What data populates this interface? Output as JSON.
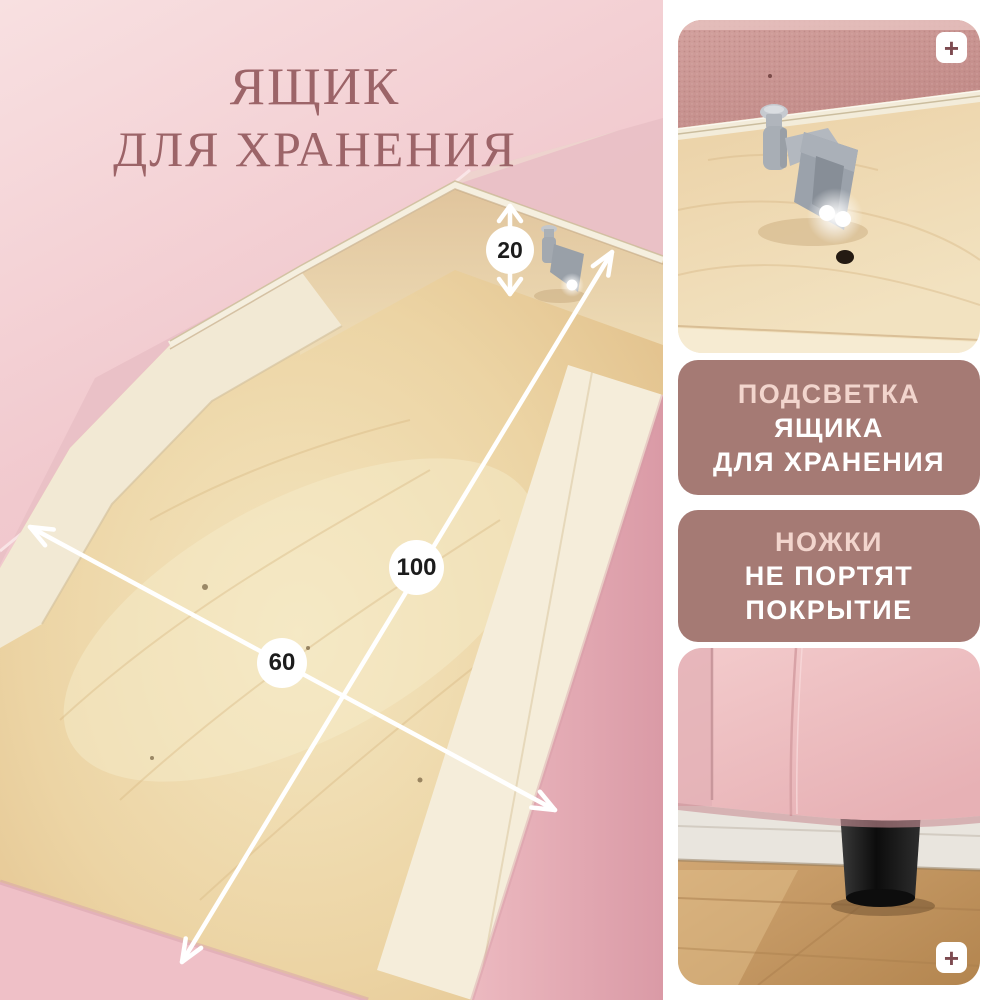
{
  "main_photo": {
    "title_line1": "ЯЩИК",
    "title_line2": "ДЛЯ ХРАНЕНИЯ",
    "dim_height": "20",
    "dim_length": "100",
    "dim_width": "60"
  },
  "side": {
    "panel_light": {
      "accent": "ПОДСВЕТКА",
      "line2": "ЯЩИКА",
      "line3": "ДЛЯ ХРАНЕНИЯ"
    },
    "panel_legs": {
      "accent": "НОЖКИ",
      "line2": "НЕ ПОРТЯТ",
      "line3": "ПОКРЫТИЕ"
    },
    "zoom_button_top": "+",
    "zoom_button_bottom": "+"
  },
  "colors": {
    "accent_panel": "#a57a74",
    "accent_text": "#f2d5cd",
    "panel_text": "#ffffff",
    "title_text": "#9c6468",
    "plus_icon": "#7d4a50",
    "dimension_text": "#1c1c1c"
  }
}
